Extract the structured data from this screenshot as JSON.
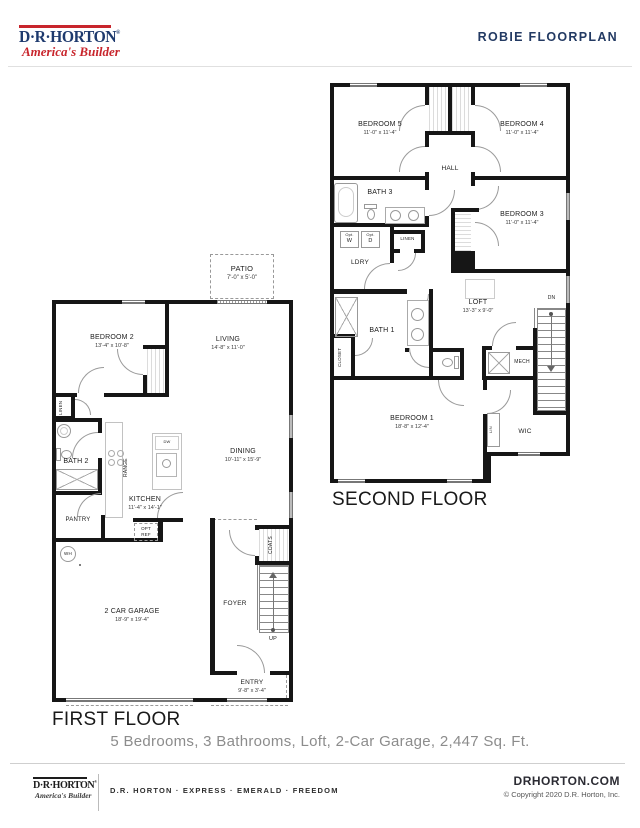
{
  "header": {
    "brand": {
      "name": "D·R·HORTON",
      "registered": "®",
      "tagline": "America's Builder"
    },
    "title": "ROBIE FLOORPLAN"
  },
  "summary": "5 Bedrooms, 3 Bathrooms, Loft, 2-Car Garage, 2,447 Sq. Ft.",
  "second_floor": {
    "title": "SECOND FLOOR",
    "rooms": {
      "bedroom5": {
        "name": "BEDROOM 5",
        "dims": "11'-0\" x 11'-4\""
      },
      "bedroom4": {
        "name": "BEDROOM 4",
        "dims": "11'-0\" x 11'-4\""
      },
      "bedroom3": {
        "name": "BEDROOM 3",
        "dims": "11'-0\" x 11'-4\""
      },
      "bedroom1": {
        "name": "BEDROOM 1",
        "dims": "18'-8\" x 12'-4\""
      },
      "loft": {
        "name": "LOFT",
        "dims": "13'-3\" x 9'-0\""
      },
      "hall": {
        "name": "HALL"
      },
      "bath3": {
        "name": "BATH 3"
      },
      "bath1": {
        "name": "BATH 1"
      },
      "ldry": {
        "name": "LDRY"
      },
      "linen": {
        "name": "LINEN"
      },
      "closet": {
        "name": "CLOSET"
      },
      "mech": {
        "name": "MECH"
      },
      "wic": {
        "name": "WIC"
      },
      "lin": {
        "name": "LIN"
      },
      "dn": {
        "name": "DN"
      },
      "opt_washer": {
        "prefix": "Opt.",
        "letter": "W"
      },
      "opt_dryer": {
        "prefix": "Opt.",
        "letter": "D"
      }
    }
  },
  "first_floor": {
    "title": "FIRST FLOOR",
    "rooms": {
      "patio": {
        "name": "PATIO",
        "dims": "7'-0\" x 5'-0\""
      },
      "bedroom2": {
        "name": "BEDROOM 2",
        "dims": "13'-4\" x 10'-8\""
      },
      "living": {
        "name": "LIVING",
        "dims": "14'-8\" x 11'-0\""
      },
      "dining": {
        "name": "DINING",
        "dims": "10'-11\" x 15'-9\""
      },
      "kitchen": {
        "name": "KITCHEN",
        "dims": "11'-4\" x 14'-1\""
      },
      "garage": {
        "name": "2 CAR GARAGE",
        "dims": "18'-9\" x 19'-4\""
      },
      "entry": {
        "name": "ENTRY",
        "dims": "9'-8\" x 3'-4\""
      },
      "linen": {
        "name": "LINEN"
      },
      "bath2": {
        "name": "BATH 2"
      },
      "pantry": {
        "name": "PANTRY"
      },
      "range": {
        "name": "RANGE"
      },
      "dw": {
        "name": "DW"
      },
      "opt_ref": {
        "line1": "OPT",
        "line2": "REF"
      },
      "wh": {
        "name": "WH"
      },
      "coats": {
        "name": "COATS"
      },
      "foyer": {
        "name": "FOYER"
      },
      "up": {
        "name": "UP"
      }
    }
  },
  "footer": {
    "brand": {
      "name": "D·R·HORTON",
      "registered": "®",
      "tagline": "America's Builder"
    },
    "brands_line": "D.R. HORTON · EXPRESS · EMERALD · FREEDOM",
    "website": "DRHORTON.COM",
    "copyright": "© Copyright 2020 D.R. Horton, Inc."
  },
  "colors": {
    "brand_navy": "#1e3a6e",
    "brand_red": "#c8252c",
    "wall": "#161616",
    "muted_text": "#8c8c8c"
  }
}
